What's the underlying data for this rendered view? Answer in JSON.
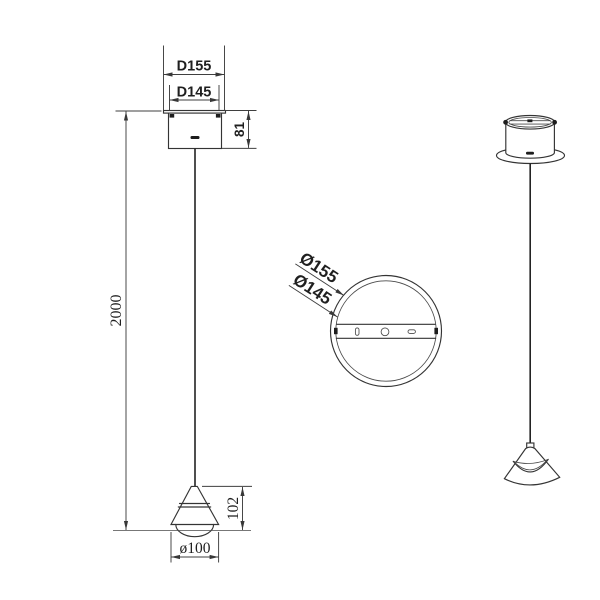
{
  "colors": {
    "background": "#ffffff",
    "line": "#343434",
    "dimension_line": "#3f3f3f",
    "text": "#1f1f1f"
  },
  "front_view": {
    "dims": {
      "canopy_outer": "D155",
      "canopy_inner": "D145",
      "canopy_height": "81",
      "suspension_length": "2000",
      "shade_height": "102",
      "shade_diameter": "ø100"
    }
  },
  "top_view": {
    "dims": {
      "outer_diameter": "Ø155",
      "inner_diameter": "Ø145"
    }
  }
}
